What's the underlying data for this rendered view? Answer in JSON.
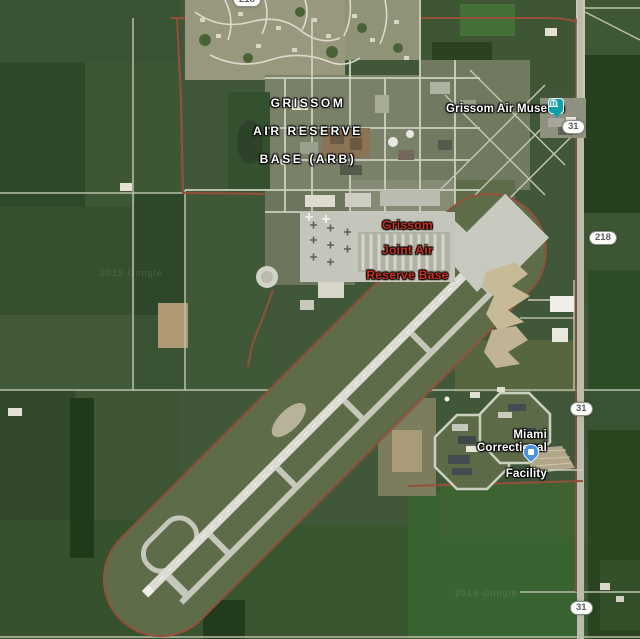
{
  "map": {
    "type": "satellite",
    "labels": {
      "base_area": {
        "line1": "GRISSOM",
        "line2": "AIR RESERVE",
        "line3": "BASE (ARB)",
        "color": "#ffffff"
      },
      "base_poi": {
        "line1": "Grissom",
        "line2": "Joint Air",
        "line3": "Reserve Base",
        "color": "#d2301c"
      },
      "museum": {
        "text": "Grissom Air Museum",
        "color": "#ffffff"
      },
      "prison": {
        "line1": "Miami Correctional",
        "line2": "Facility",
        "color": "#ffffff"
      }
    },
    "shields": {
      "top_218": "218",
      "right_31_north": "31",
      "right_218": "218",
      "right_31_mid": "31",
      "right_31_south": "31"
    },
    "icons": {
      "museum": {
        "name": "museum-poi-icon",
        "color": "#0f9fa8"
      },
      "prison": {
        "name": "prison-poi-icon",
        "color": "#4a90e2"
      }
    },
    "watermark": "2019 Google"
  }
}
